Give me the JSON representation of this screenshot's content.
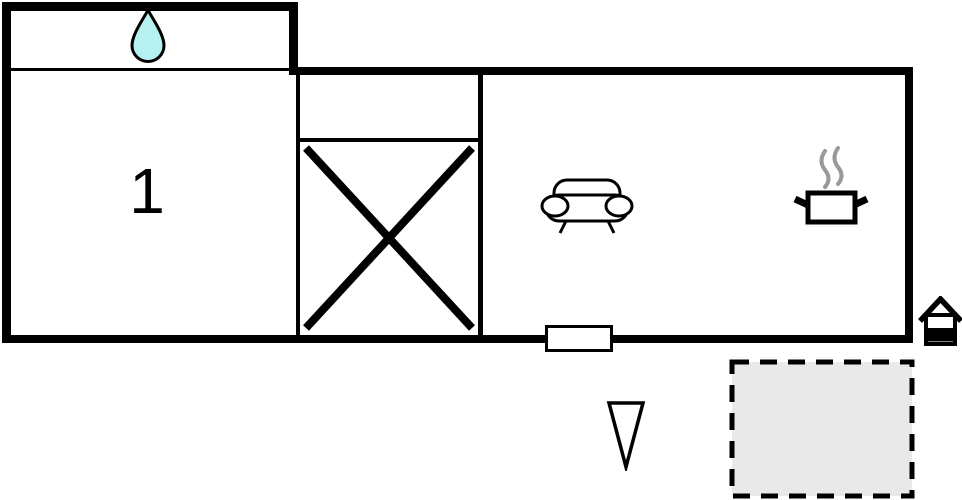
{
  "plan": {
    "type": "floor-plan",
    "rooms": {
      "bathroom": {
        "feature_icon": "water-drop"
      },
      "bedroom": {
        "label": "1"
      },
      "crossed_area": {
        "marker": "x-cross"
      },
      "living_kitchen": {
        "icons": [
          "sofa",
          "cooking-pot"
        ]
      },
      "terrace": {
        "border_style": "dashed"
      }
    },
    "annotations": {
      "entrance_pointer": "triangle-down",
      "outbuilding": "grill-house",
      "wall_opening": "window"
    },
    "colors": {
      "wall": "#000000",
      "background": "#ffffff",
      "water_drop": "#b5f1f1",
      "terrace_fill": "#e9e9e9",
      "steam": "#999999"
    }
  }
}
